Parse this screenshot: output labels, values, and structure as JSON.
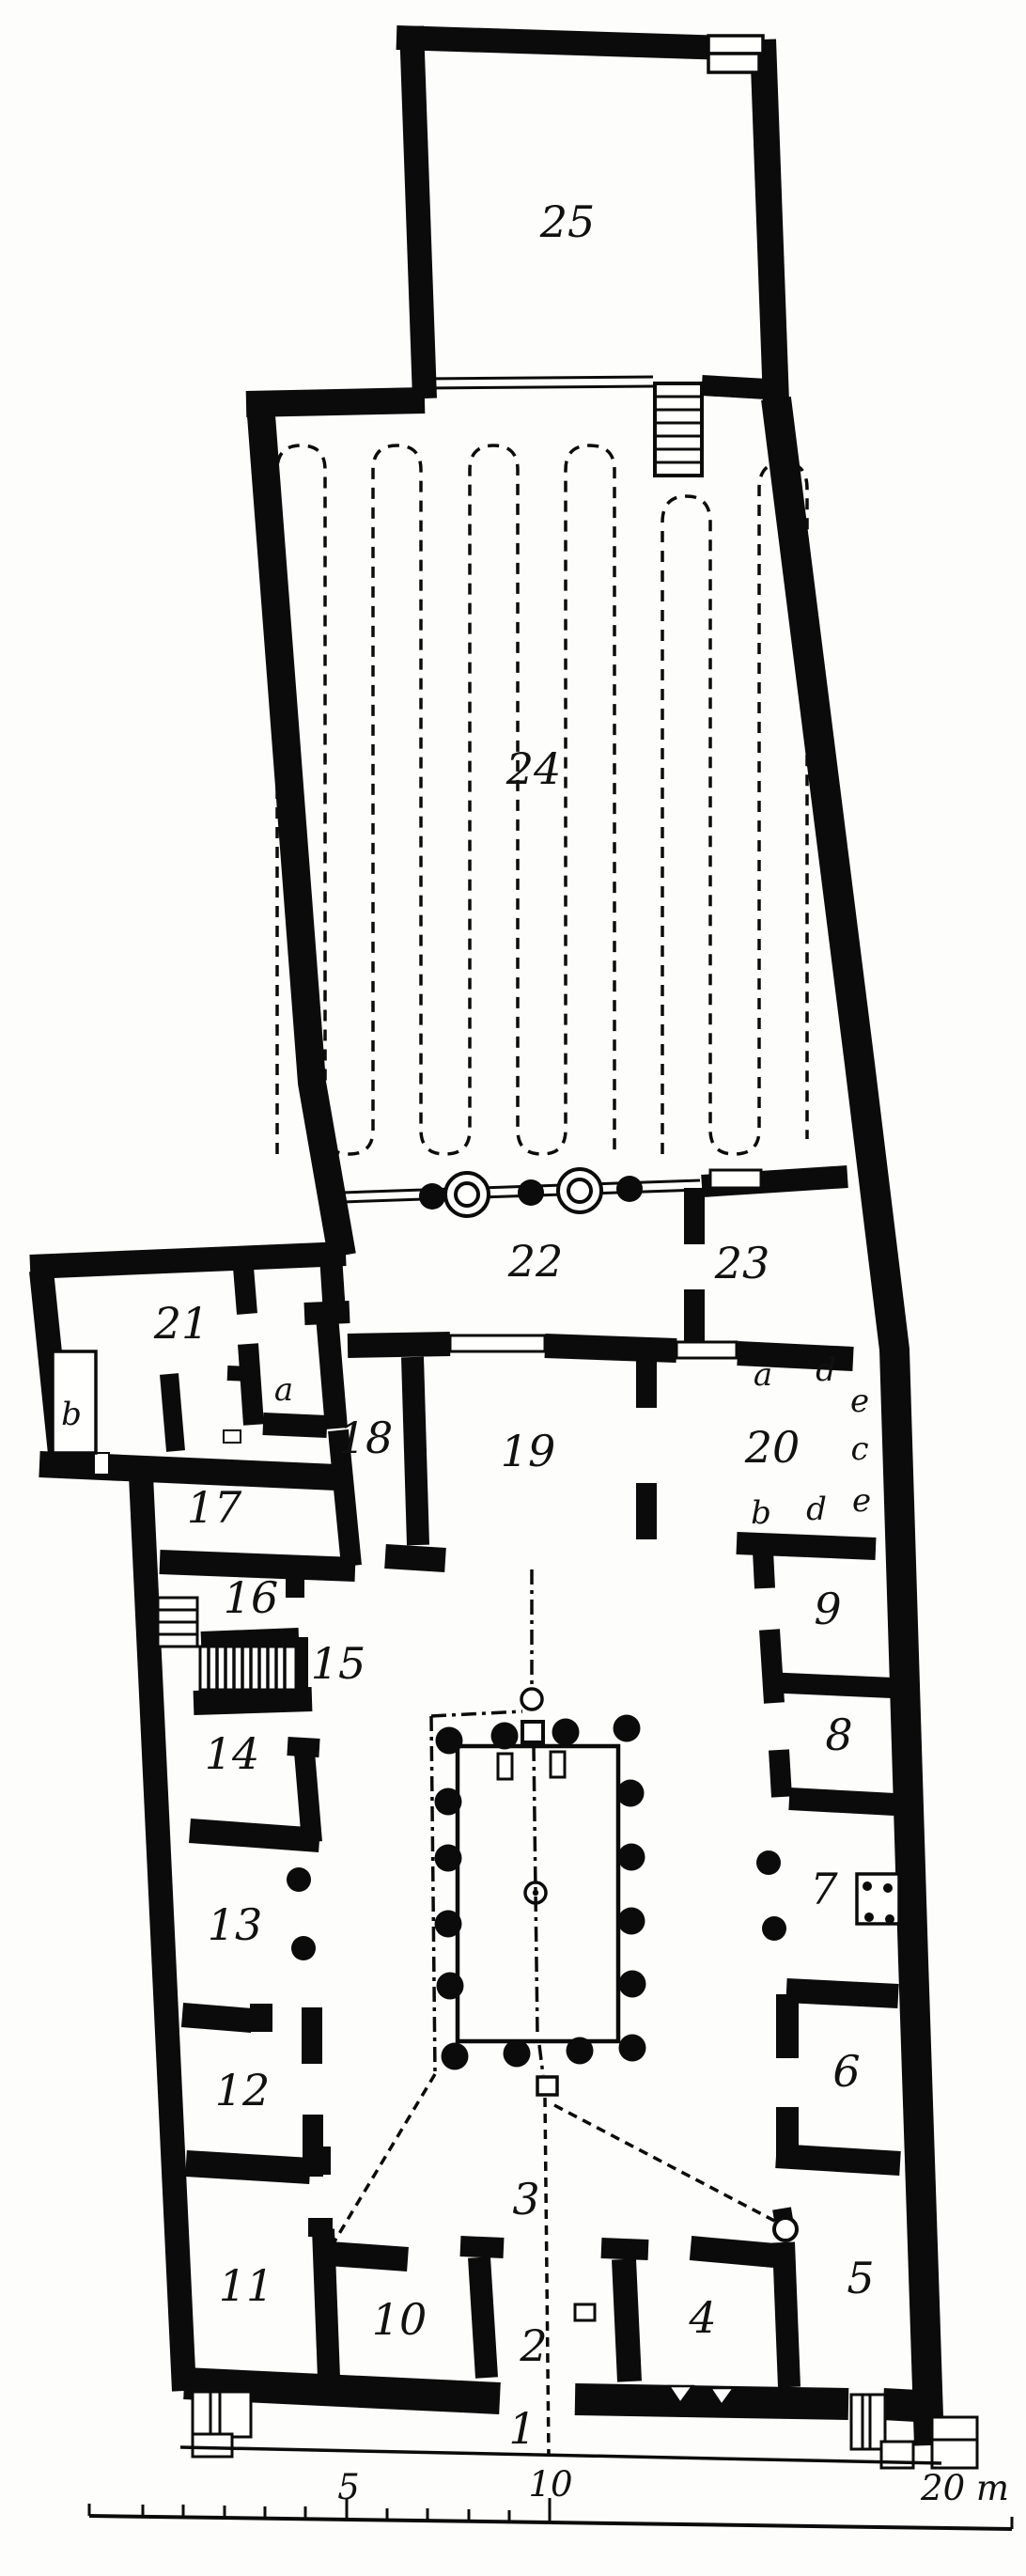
{
  "rooms": {
    "n1": "1",
    "n2": "2",
    "n3": "3",
    "n4": "4",
    "n5": "5",
    "n6": "6",
    "n7": "7",
    "n8": "8",
    "n9": "9",
    "n10": "10",
    "n11": "11",
    "n12": "12",
    "n13": "13",
    "n14": "14",
    "n15": "15",
    "n16": "16",
    "n17": "17",
    "n18": "18",
    "n19": "19",
    "n20": "20",
    "n21": "21",
    "n22": "22",
    "n23": "23",
    "n24": "24",
    "n25": "25"
  },
  "letters": {
    "b_closet": "b",
    "a_annex": "a",
    "a_20": "a",
    "d_20_top": "d",
    "e_20_right_top": "e",
    "c_20": "c",
    "b_20": "b",
    "d_20_bottom": "d",
    "e_20_bottom": "e"
  },
  "scale_bar": {
    "t5": "5",
    "t10": "10",
    "t20": "20 m"
  }
}
